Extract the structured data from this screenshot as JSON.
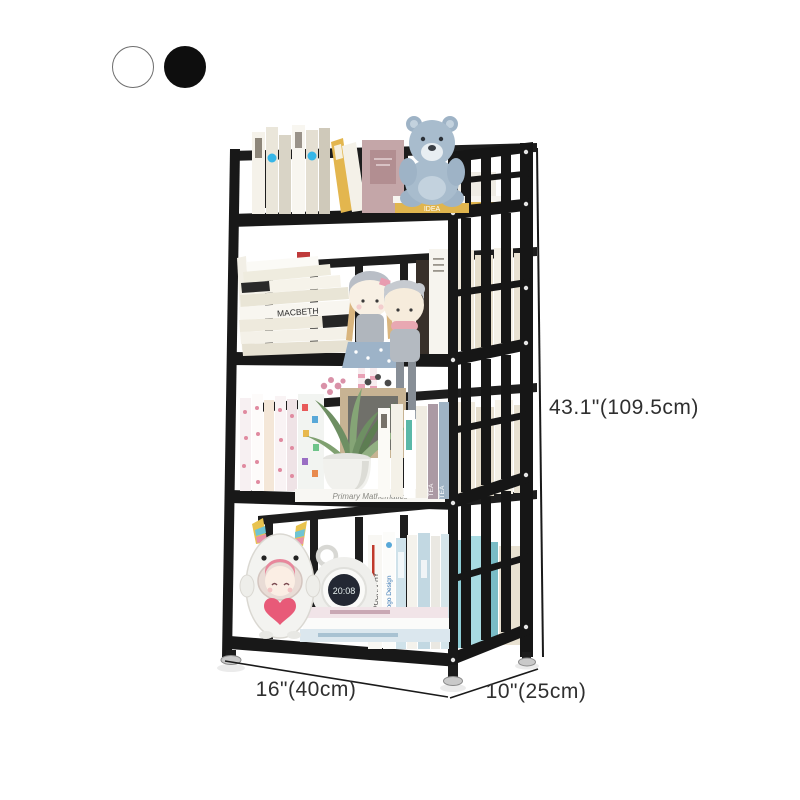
{
  "product": {
    "kind": "4-tier metal bookshelf product photo",
    "frame_color": "#1b1b1b",
    "background_color": "#ffffff",
    "color_options": [
      {
        "name": "white",
        "hex": "#ffffff"
      },
      {
        "name": "black",
        "hex": "#0e0e0e"
      }
    ],
    "dimensions": {
      "height": "43.1\"(109.5cm)",
      "width": "16\"(40cm)",
      "depth": "10\"(25cm)"
    },
    "decor_text": {
      "book_macbeth": "MACBETH",
      "book_idea": "IDEA",
      "book_tea": "TEA",
      "book_math": "Primary Mathematics",
      "book_typography": "TYPOGRAPHY",
      "book_logo_design": "Logo Design",
      "clock_time": "20:08"
    },
    "accent_colors": {
      "sticker_blue": "#35b6e8",
      "heart_pink": "#e85a78",
      "dimension_text": "#2f2f2f"
    }
  }
}
